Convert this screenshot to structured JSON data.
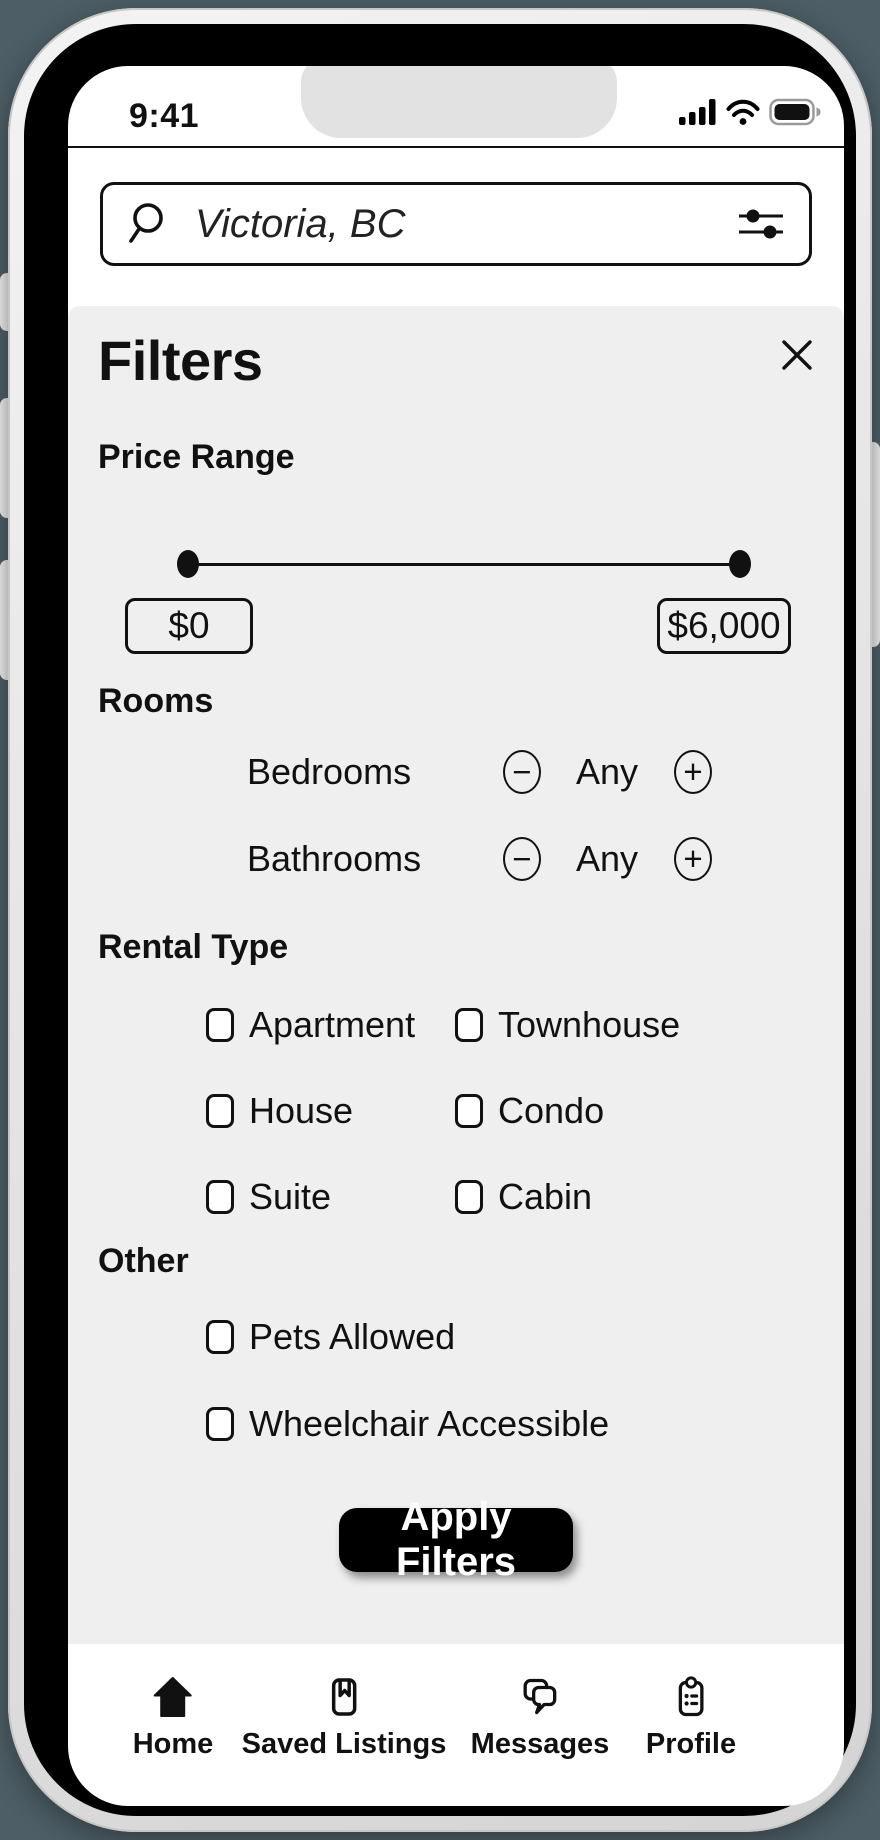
{
  "status_bar": {
    "time": "9:41",
    "icons": [
      "cellular-signal-icon",
      "wifi-icon",
      "battery-icon"
    ]
  },
  "search": {
    "icon": "search-icon",
    "placeholder": "Victoria, BC",
    "filter_icon": "sliders-icon"
  },
  "filters": {
    "title": "Filters",
    "close_icon": "close-icon",
    "price": {
      "label": "Price Range",
      "min_value": "$0",
      "max_value": "$6,000",
      "slider_min_percent": 0,
      "slider_max_percent": 100
    },
    "rooms": {
      "label": "Rooms",
      "rows": [
        {
          "label": "Bedrooms",
          "value": "Any",
          "minus": "−",
          "plus": "+"
        },
        {
          "label": "Bathrooms",
          "value": "Any",
          "minus": "−",
          "plus": "+"
        }
      ]
    },
    "rental_type": {
      "label": "Rental Type",
      "options": [
        "Apartment",
        "Townhouse",
        "House",
        "Condo",
        "Suite",
        "Cabin"
      ],
      "checked": [
        false,
        false,
        false,
        false,
        false,
        false
      ]
    },
    "other": {
      "label": "Other",
      "options": [
        "Pets Allowed",
        "Wheelchair Accessible"
      ],
      "checked": [
        false,
        false
      ]
    },
    "apply_label": "Apply Filters"
  },
  "nav": {
    "items": [
      {
        "label": "Home",
        "icon": "home-icon"
      },
      {
        "label": "Saved Listings",
        "icon": "bookmark-icon"
      },
      {
        "label": "Messages",
        "icon": "messages-icon"
      },
      {
        "label": "Profile",
        "icon": "clipboard-icon"
      }
    ]
  },
  "colors": {
    "panel_bg": "#efeff0",
    "apply_button_bg": "#000000",
    "text": "#111111",
    "notch": "#e2e2e2",
    "backdrop": "#4d5e66"
  }
}
